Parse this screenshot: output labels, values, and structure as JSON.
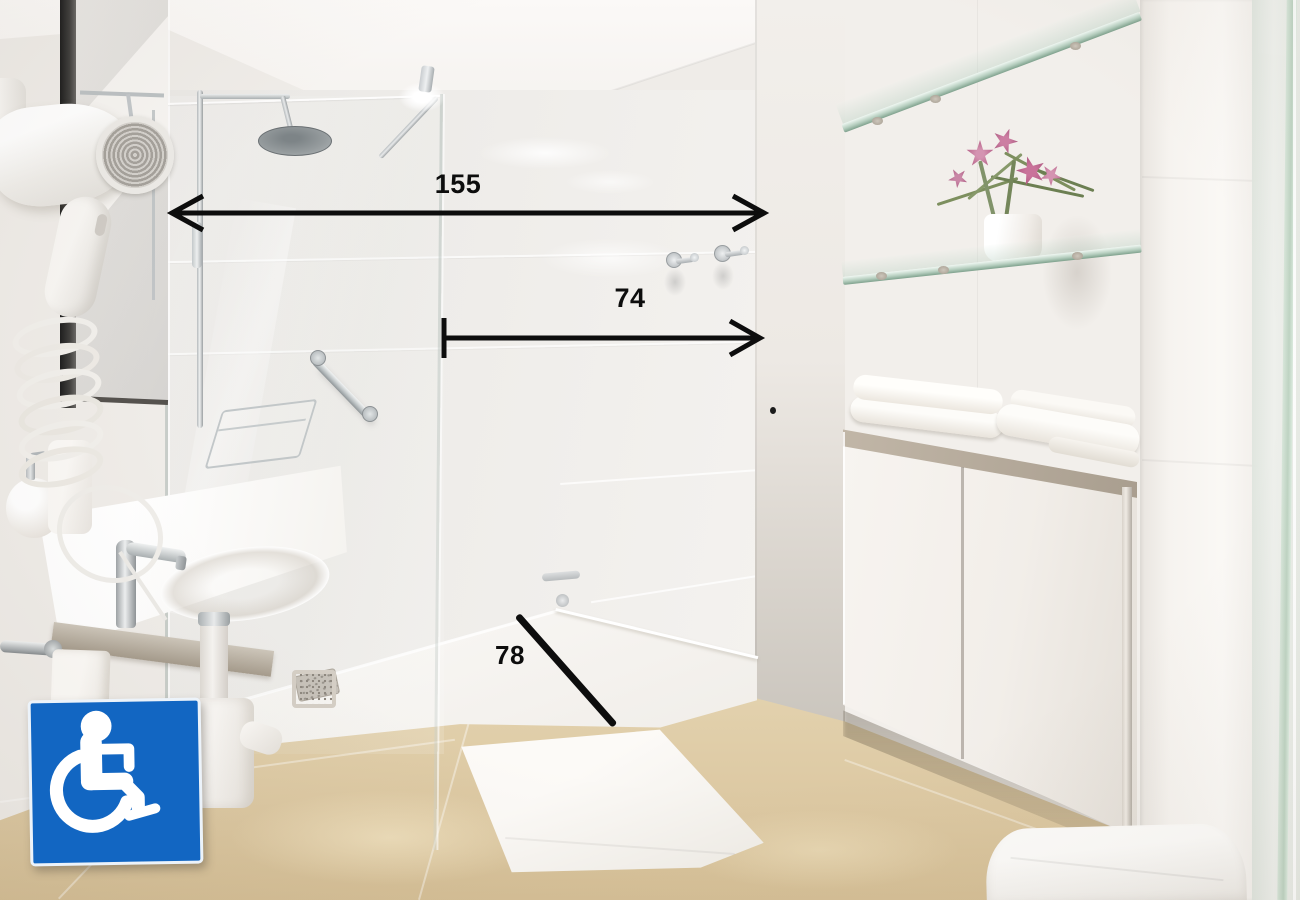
{
  "annotations": {
    "measurements": [
      {
        "name": "shower-opening-width",
        "label": "155"
      },
      {
        "name": "entry-clearance-width",
        "label": "74"
      },
      {
        "name": "shower-tray-depth",
        "label": "78"
      }
    ],
    "sign": {
      "symbol": "wheelchair-accessibility",
      "background_color": "#1266c2",
      "symbol_color": "#ffffff"
    }
  },
  "scene": {
    "description": "Accessible bathroom with roll-in shower, annotated with measurements",
    "objects": [
      "wall-mounted-hair-dryer",
      "mirror",
      "washbasin-counter",
      "faucet",
      "soap-dispenser",
      "grab-bar",
      "shower-column",
      "rain-shower-head",
      "shower-glass-panel",
      "shower-tray",
      "drain-grate",
      "wall-hooks",
      "glass-shelves",
      "flower-pot",
      "folded-towels",
      "vanity-cabinet",
      "toilet",
      "bath-mat",
      "beige-tiled-floor"
    ],
    "palette": {
      "wall": "#f0ede9",
      "ceiling": "#f8f6f3",
      "floor": "#dcc8a2",
      "fixtures": "#ffffff",
      "glass_tint": "#cfe0d2",
      "accent_blue": "#1266c2",
      "annotation": "#0d0d0d"
    }
  }
}
